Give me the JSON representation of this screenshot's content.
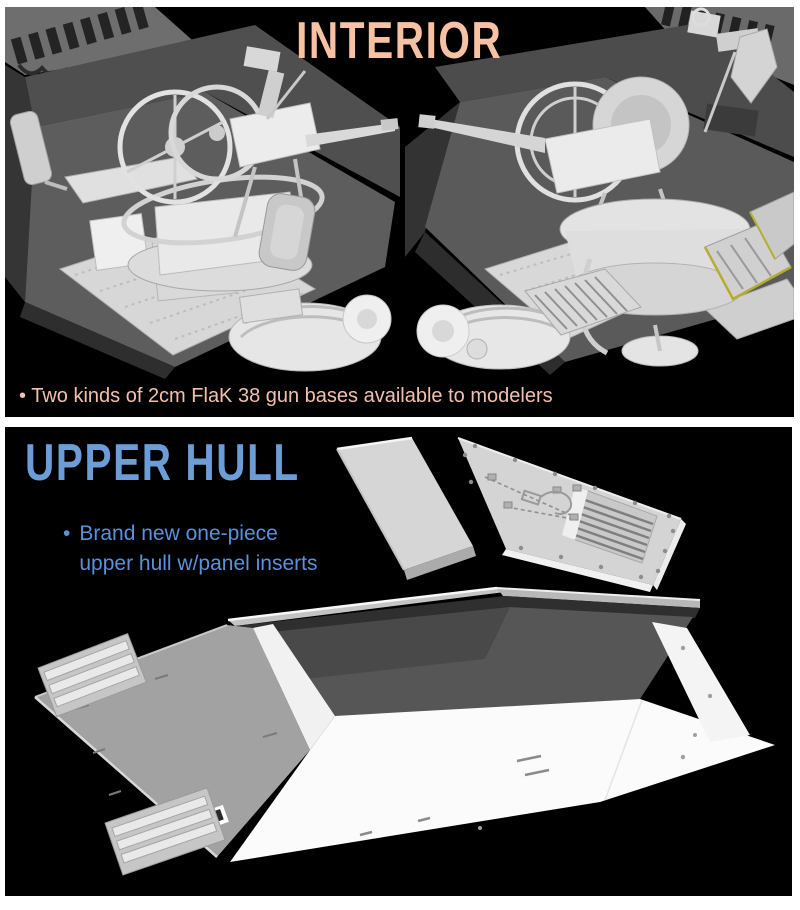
{
  "interior_section": {
    "title": "INTERIOR",
    "title_color": "#F6C2A3",
    "bullet_glyph": "•",
    "bullet_text": "Two kinds of 2cm FlaK 38 gun bases available to modelers",
    "bullet_color": "#F2C1AE",
    "background": "#000000",
    "renders": {
      "left_render": "2cm FlaK 38 gun interior view A (CAD render)",
      "right_render": "2cm FlaK 38 gun interior view B (CAD render)"
    }
  },
  "upper_hull_section": {
    "title": "UPPER HULL",
    "title_color": "#6D9DD6",
    "bullet_glyph": "•",
    "bullet_line1": "Brand new one-piece",
    "bullet_line2": "upper hull w/panel inserts",
    "bullet_color": "#5B90DA",
    "background": "#000000",
    "renders": {
      "hull_render": "one-piece upper hull (CAD render)",
      "panel_inserts": "panel inserts (CAD render)"
    }
  }
}
